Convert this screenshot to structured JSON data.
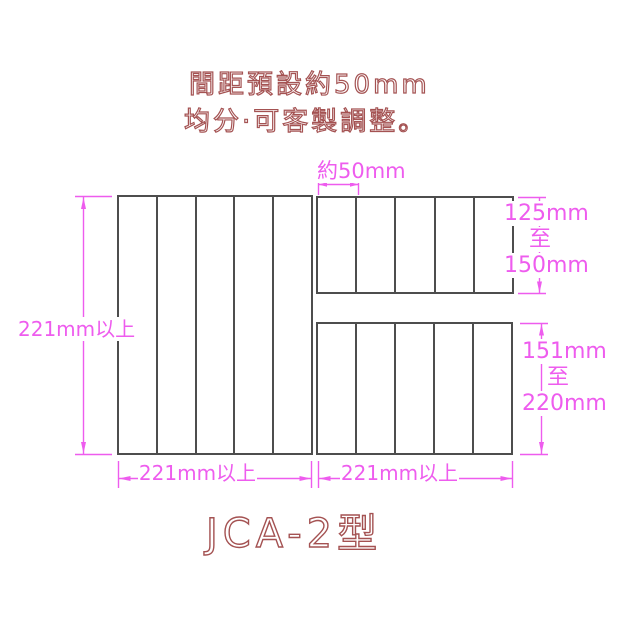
{
  "colors": {
    "dimension": "#ee5cee",
    "outline": "#a45252",
    "border": "#4d4d4d",
    "bg": "#ffffff"
  },
  "header": {
    "line1": "間距預設約50mm",
    "line2": "均分·可客製調整。"
  },
  "title": "JCA-2型",
  "panels": {
    "left": {
      "slat_count": 5
    },
    "top_right": {
      "slat_count": 5
    },
    "bottom_right": {
      "slat_count": 5
    }
  },
  "dimensions": {
    "spacing": {
      "label": "約50mm"
    },
    "left_height": {
      "label": "221mm以上"
    },
    "left_width": {
      "label": "221mm以上"
    },
    "right_width": {
      "label": "221mm以上"
    },
    "right_top_height": {
      "from": "125mm",
      "connector": "至",
      "to": "150mm"
    },
    "right_bottom_height": {
      "from": "151mm",
      "connector": "至",
      "to": "220mm"
    }
  }
}
